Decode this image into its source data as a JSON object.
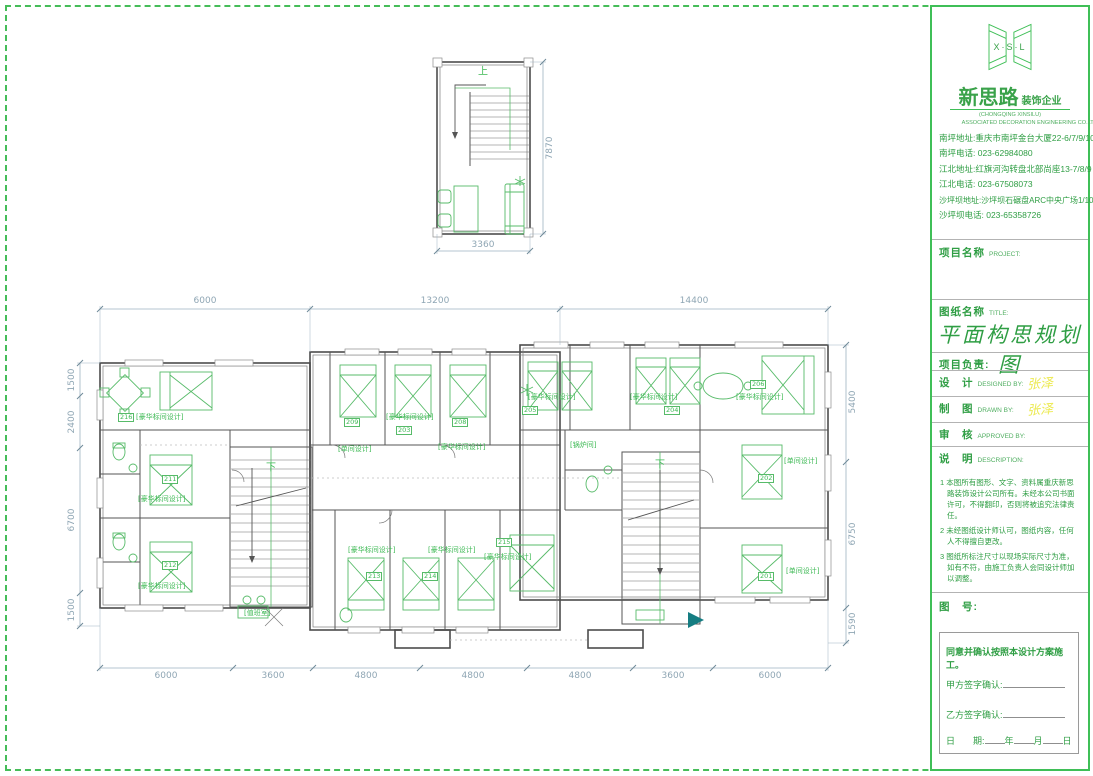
{
  "title_block": {
    "logo": {
      "letters": "X·S·L",
      "name": "新思路",
      "suffix": "装饰企业",
      "en1": "(CHONGQING XINSILU)",
      "en2": "ASSOCIATED DECORATION ENGINEERING CO.LTD"
    },
    "addresses": [
      "南坪地址:重庆市南坪金台大厦22-6/7/9/10",
      "南坪电话: 023-62984080",
      "江北地址:红旗河沟转盘北部尚座13-7/8/9",
      "江北电话: 023-67508073",
      "沙坪坝地址:沙坪坝石碾盘ARC中央广场1/10/3",
      "沙坪坝电话: 023-65358726"
    ],
    "project_label": "项目名称",
    "project_en": "PROJECT:",
    "sheet_label": "图纸名称",
    "sheet_en": "TITLE:",
    "sheet_title": "平面构思规划图",
    "manager_label": "项目负责:",
    "design_label": "设　计",
    "design_en": "DESIGNED BY:",
    "design_sig": "张泽",
    "draft_label": "制　图",
    "draft_en": "DRAWN BY:",
    "draft_sig": "张泽",
    "review_label": "审　核",
    "review_en": "APPROVED BY:",
    "desc_label": "说　明",
    "desc_en": "DESCRIPTION:",
    "notes": [
      "1 本图所有图形、文字、资料属重庆新思路装饰设计公司所有。未经本公司书面许可，不得翻印，否则将被追究法律责任。",
      "2 未经图纸设计师认可，图纸内容，任何人不得擅自更改。",
      "3 图纸所标注尺寸以现场实际尺寸为准，如有不符，由施工负责人会同设计师加以调整。"
    ],
    "number_label": "图　号:",
    "confirm": {
      "statement": "同意并确认按照本设计方案施工。",
      "party_a": "甲方签字确认:",
      "party_b": "乙方签字确认:",
      "date_label": "日　　期:",
      "year": "年",
      "month": "月",
      "day": "日"
    }
  },
  "plan": {
    "up": "上",
    "down_left": "下",
    "down_right": "下",
    "labels": [
      "[豪华标间设计]",
      "[豪华标间设计]",
      "[豪华标间设计]",
      "[单间设计]",
      "[豪华标间设计]",
      "[豪华标间设计]",
      "[豪华标间设计]",
      "[豪华标间设计]",
      "[豪华标间设计]",
      "[单间设计]",
      "[单间设计]",
      "[锅炉间]",
      "[豪华标间设计]",
      "[豪华标间设计]",
      "[豪华标间设计]",
      "[值班室]"
    ],
    "numbers": [
      "216",
      "211",
      "212",
      "209",
      "203",
      "208",
      "205",
      "204",
      "206",
      "202",
      "201",
      "213",
      "214",
      "215"
    ]
  },
  "dims": {
    "top": [
      "6000",
      "13200",
      "14400"
    ],
    "bottom": [
      "6000",
      "3600",
      "4800",
      "4800",
      "4800",
      "3600",
      "6000"
    ],
    "left": [
      "1500",
      "2400",
      "6700",
      "1500"
    ],
    "right": [
      "5400",
      "6750",
      "1590"
    ],
    "small_bottom": "3360",
    "small_right": "7870"
  }
}
